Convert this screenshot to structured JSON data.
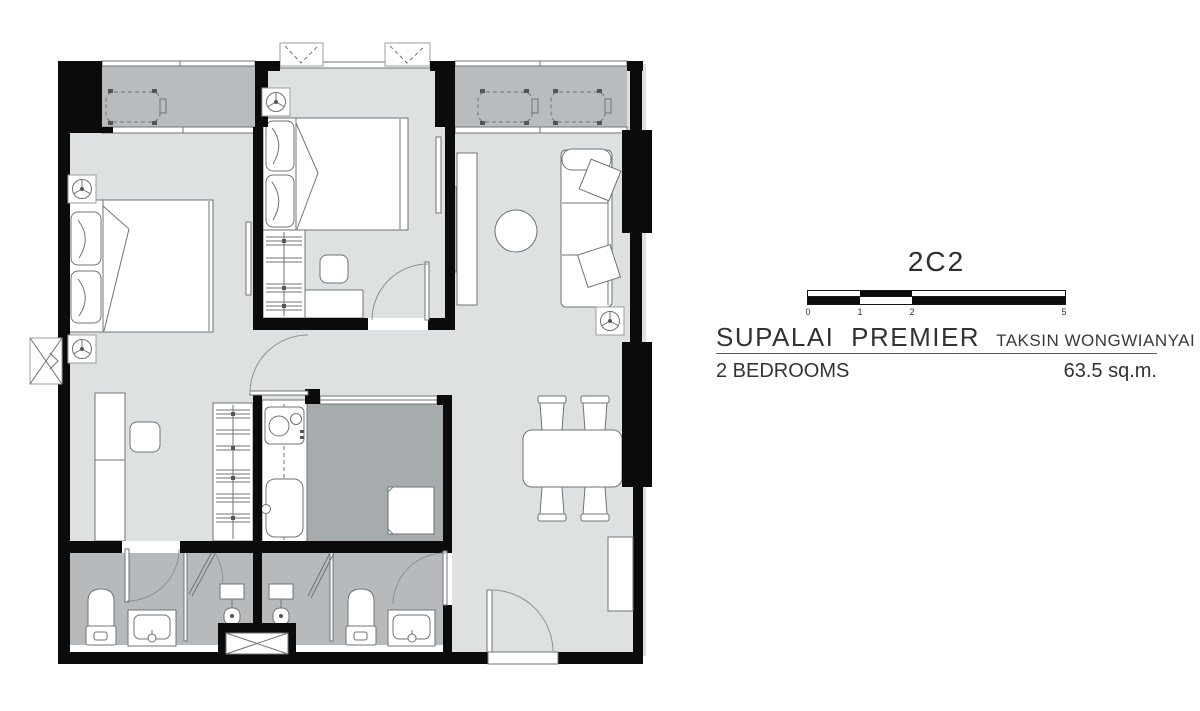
{
  "panel": {
    "unit_code": "2C2",
    "project_name": "SUPALAI PREMIER",
    "project_location": "TAKSIN WONGWIANYAI",
    "bedrooms_label": "2 BEDROOMS",
    "area_label": "63.5 sq.m."
  },
  "scale_bar": {
    "ticks": [
      "0",
      "1",
      "2",
      "5"
    ]
  },
  "colors": {
    "wall": "#0b0b0b",
    "floor": "#dee1e2",
    "balcony": "#b8bcbe",
    "kitchen": "#a6abad",
    "bathroom": "#b6babc",
    "text": "#2e2e2e"
  }
}
